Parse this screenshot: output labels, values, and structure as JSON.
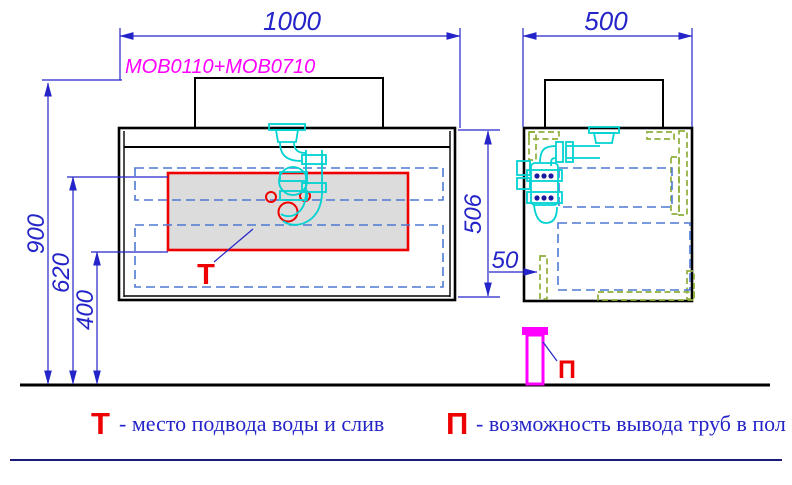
{
  "drawing": {
    "model_label": "MOB0110+MOB0710",
    "dimensions": {
      "front_width": "1000",
      "side_depth": "500",
      "total_height": "900",
      "drain_height": "620",
      "supply_height": "400",
      "cabinet_height": "506",
      "floor_offset": "50"
    },
    "markers": {
      "t": "Т",
      "p": "П"
    }
  },
  "legend": {
    "t_symbol": "Т",
    "t_text": "- место подвода воды и слив",
    "p_symbol": "П",
    "p_text": "- возможность вывода труб в пол"
  },
  "colors": {
    "dimension_blue": "#2424c8",
    "dashed_blue": "#4d79d2",
    "red": "#ee0000",
    "magenta": "#ff00ff",
    "cyan": "#00d2d2",
    "green": "#8fae3a",
    "drawer_gray_fill": "#dcdcdc",
    "navy_footer_line": "#1a1a78",
    "black": "#000000"
  }
}
